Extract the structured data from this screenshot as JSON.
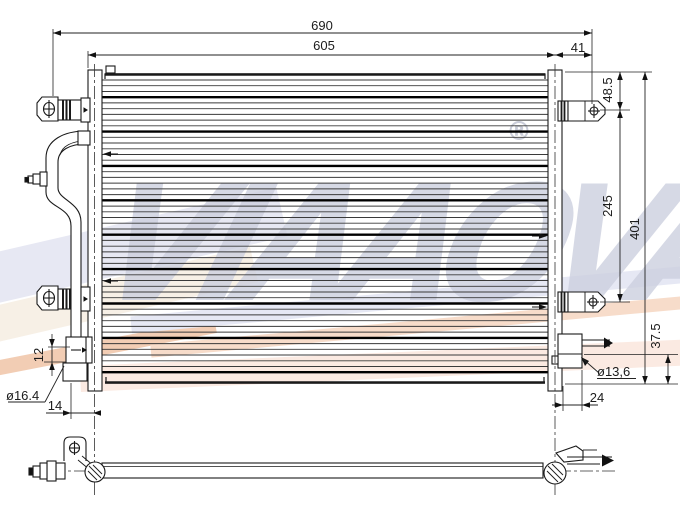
{
  "drawing": {
    "title": "condenser-technical-drawing",
    "views": [
      "front",
      "bottom"
    ],
    "dimensions": {
      "overall_width": "690",
      "core_width": "605",
      "right_bracket_offset": "41",
      "bracket_top_offset": "48.5",
      "bracket_hole_spacing": "245",
      "core_height": "401",
      "outlet_bottom_offset": "37.5",
      "inlet_block_height": "12",
      "inlet_diameter": "ø16.4",
      "inlet_pipe_offset": "14",
      "outlet_diameter": "ø13,6",
      "outlet_offset": "24"
    },
    "watermark": {
      "text": "VIAAOVA",
      "registered_mark": "®"
    },
    "colors": {
      "line": "#1a1a1a",
      "watermark_letters": "#cdd0df",
      "band_lavender": "#e7e8f3",
      "band_cream": "#f7f0e6",
      "band_orange": "#f2cdb4",
      "band_salmon": "#f7dcca"
    }
  }
}
